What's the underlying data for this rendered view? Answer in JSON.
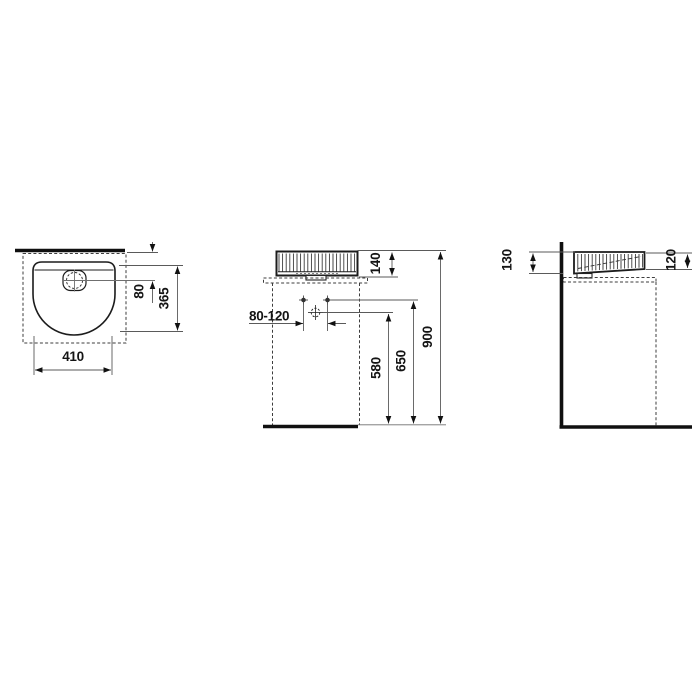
{
  "drawing": {
    "title": "washbasin-dimension-drawing",
    "top_view": {
      "dims": {
        "overall_width": "410",
        "overall_depth": "365",
        "drain_offset": "80"
      }
    },
    "front_view": {
      "dims": {
        "basin_height": "140",
        "tap_connection_range": "80-120",
        "drain_connection_height": "580",
        "supply_connection_height": "650",
        "rim_height": "900"
      }
    },
    "side_view": {
      "dims": {
        "height_back": "130",
        "height_front": "120"
      }
    }
  }
}
